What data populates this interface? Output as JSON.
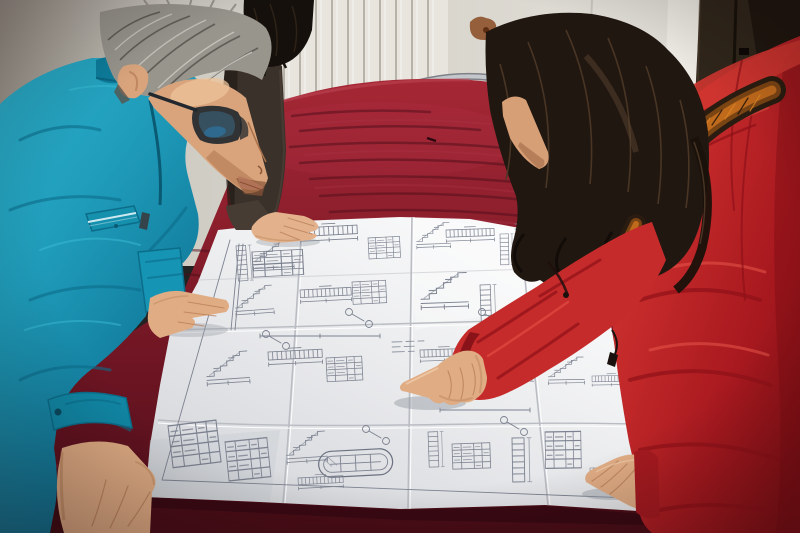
{
  "meta": {
    "type": "photograph",
    "description": "Indoor photo: a man in a teal work jacket with glasses and gray hair leans over a large engineering blueprint spread on a dark crimson velvet-covered table while a woman in a red down coat with an orange fur-trimmed hood points at a detail; a third person in dark clothing rests a hand on the drawing. Background: white radiator, plaster wall and a dark wooden door."
  },
  "palette": {
    "wall_left": "#9d978d",
    "wall": "#d6d3cb",
    "radiator": "#e8e5de",
    "radiator_fin": "#b6b1a6",
    "stain": "#8a4a22",
    "door_frame": "#edeae3",
    "door": "#30261b",
    "door_dark": "#1b130c",
    "chair_metal": "#c3c6ca",
    "chair_seat": "#a32331",
    "table_top": "#8e1f2d",
    "table_sheen": "#b03042",
    "table_front": "#4a0d17",
    "table_corner": "#420c15",
    "paper": "#eceded",
    "crease": "#b9bcc2",
    "ink": "#7c8290",
    "jacket": "#1f9cba",
    "jacket_dark": "#0c6d8a",
    "collar": "#0d7d9c",
    "pocket_piping": "#cfe9f1",
    "man_hair": "#98958d",
    "skin": "#d9a47c",
    "skin_light": "#ecc39a",
    "skin_shadow": "#b27a52",
    "hand_skin": "#e0ac84",
    "glasses": "#22282e",
    "lens_blue": "#2e6e96",
    "third_coat": "#3a312a",
    "third_hair": "#15100c",
    "woman_hair": "#211711",
    "coat": "#c62b2b",
    "coat_dark": "#8e1118",
    "coat_bright": "#cf3530",
    "hood_fold": "#e04b40",
    "fur_orange": "#c06a1c",
    "zipper": "#1a100d",
    "hand_shadow": "#9aa0a8",
    "cuff_inner": "#7e0f16",
    "cuff_red": "#a51a20"
  },
  "scene": {
    "objects": [
      {
        "name": "engineer",
        "label": "man in teal work jacket with glasses"
      },
      {
        "name": "visitor",
        "label": "woman in red fur-hooded down coat pointing"
      },
      {
        "name": "bystander",
        "label": "partially visible person in dark jacket"
      },
      {
        "name": "blueprint",
        "label": "large folded construction drawing sheet"
      },
      {
        "name": "table",
        "label": "crimson velvet covered table"
      },
      {
        "name": "radiator",
        "label": "white wall radiator"
      },
      {
        "name": "door",
        "label": "dark wooden door"
      },
      {
        "name": "chair",
        "label": "metal-frame chair with red seat"
      }
    ]
  }
}
